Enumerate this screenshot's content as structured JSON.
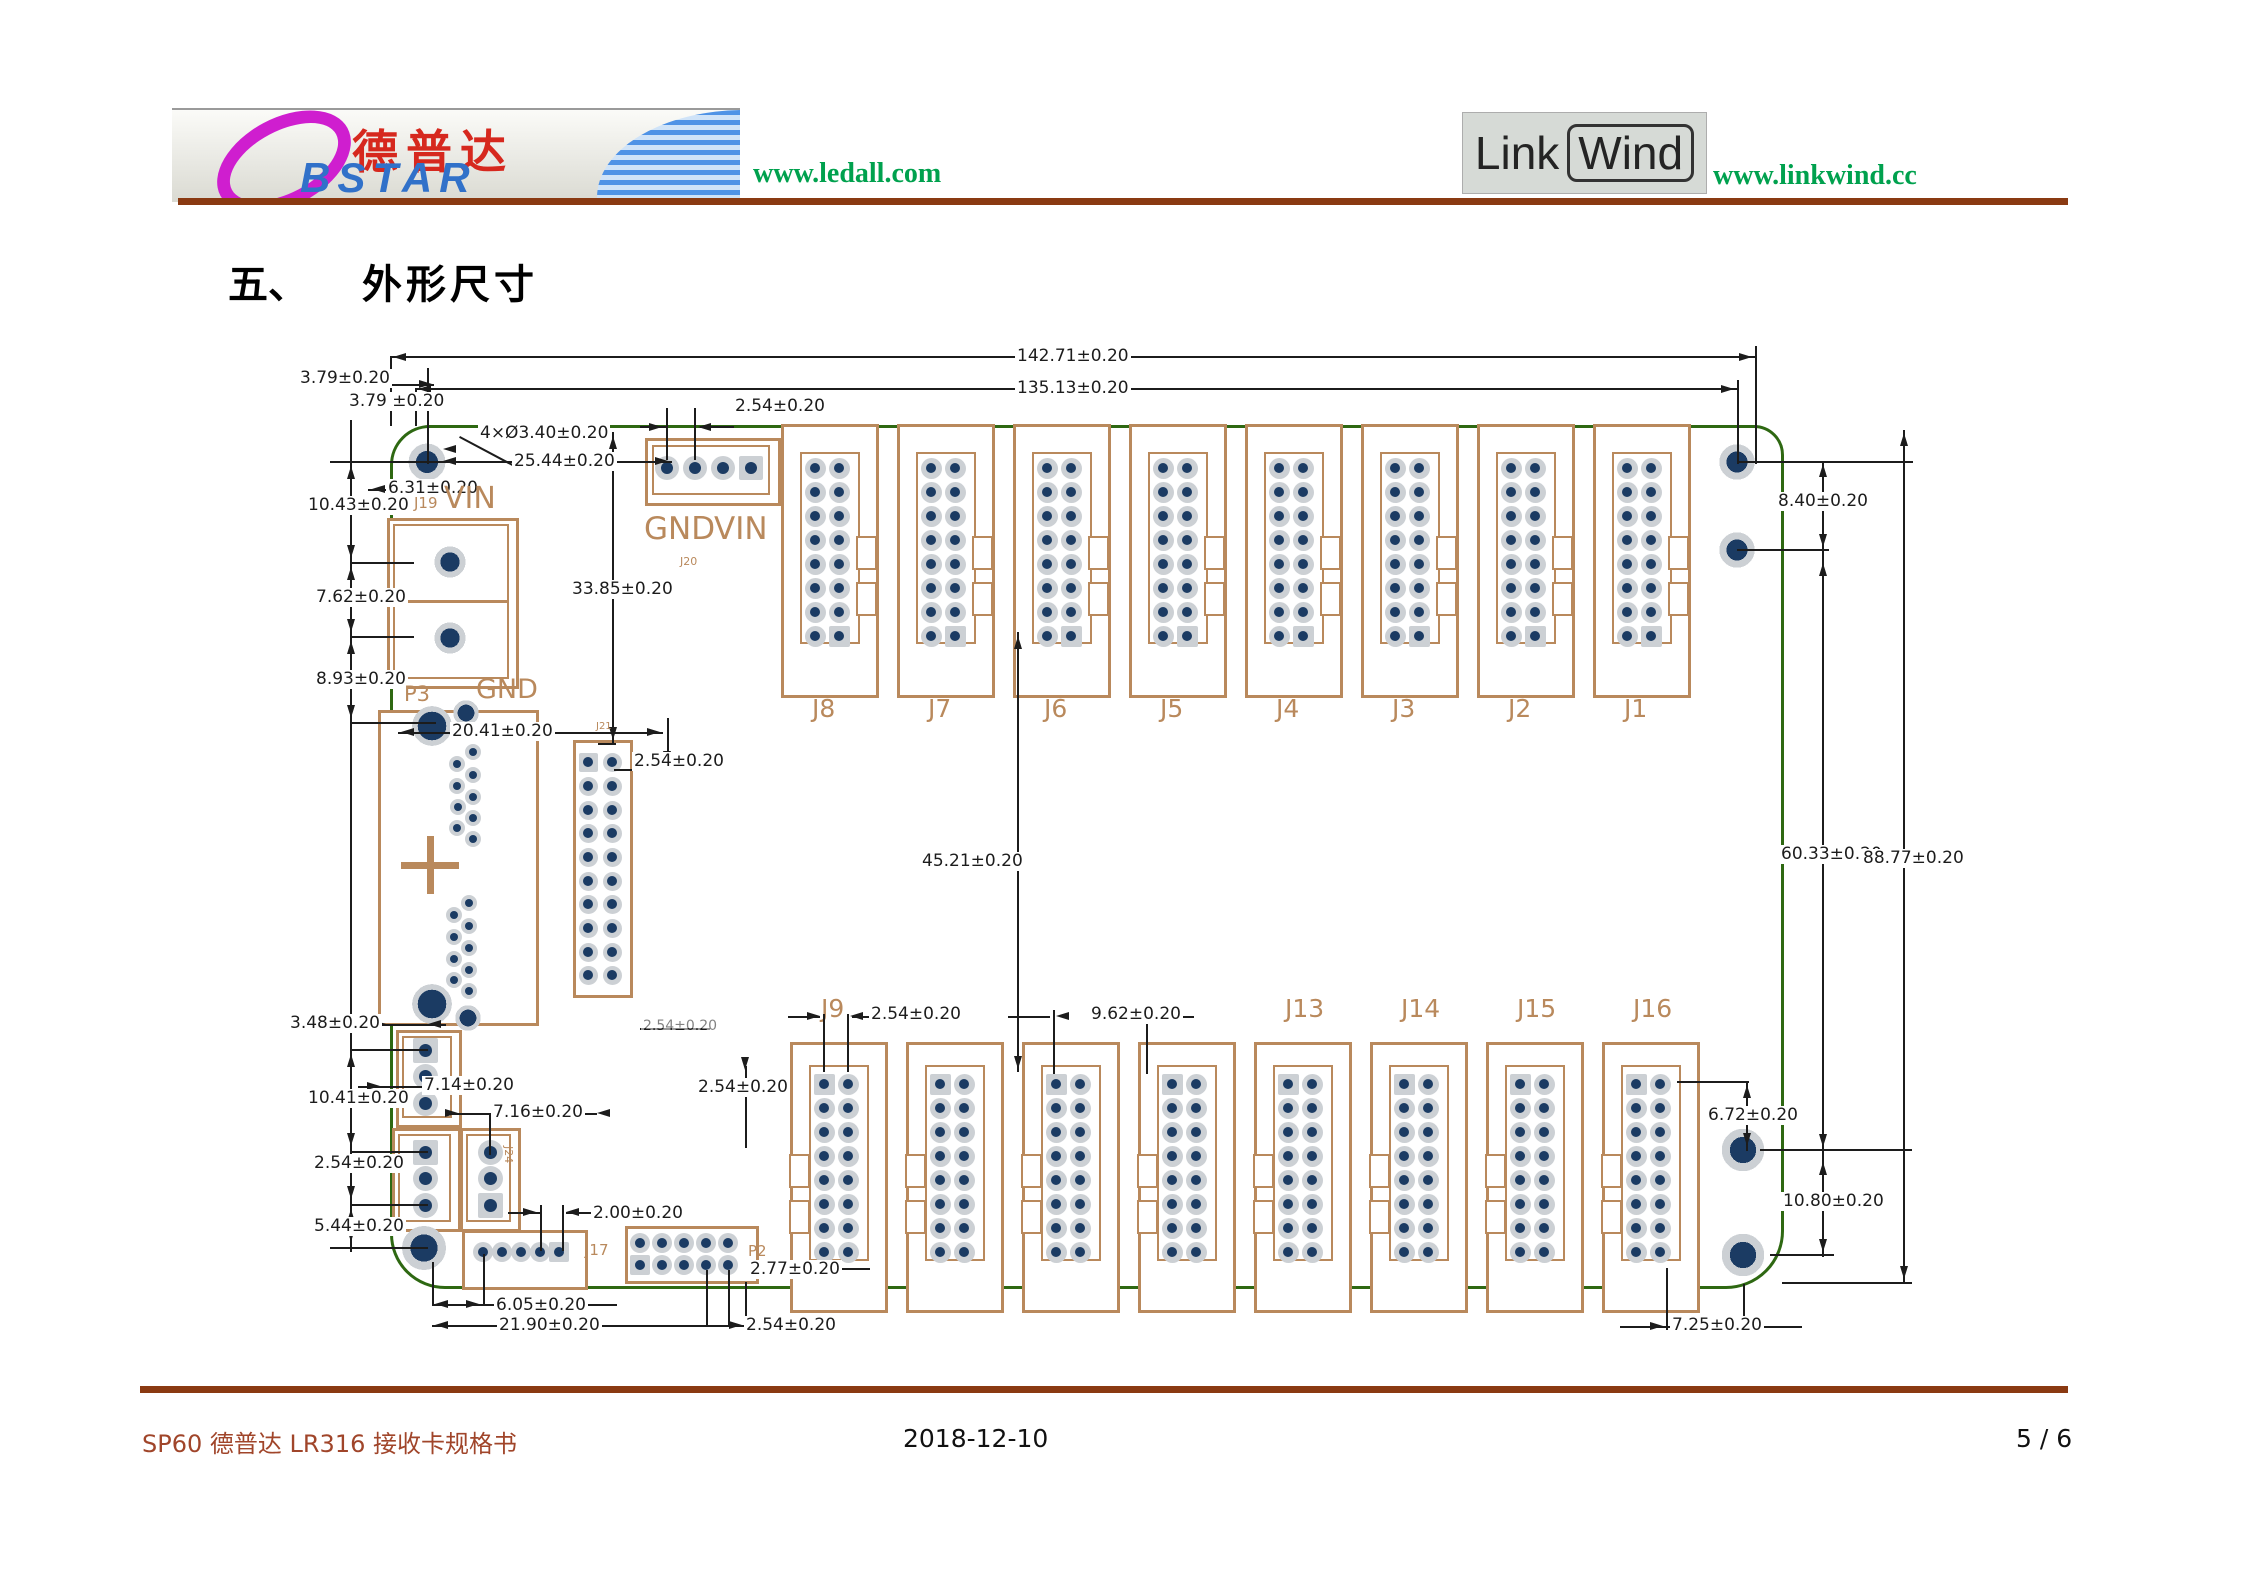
{
  "header": {
    "bstar_logo": {
      "d_initial": "D",
      "cn_name": "德普达",
      "en_name": "BSTAR"
    },
    "ledall_url": "www.ledall.com",
    "linkwind_logo": {
      "part1": "Link",
      "part2": "Wind"
    },
    "linkwind_url": "www.linkwind.cc"
  },
  "title": {
    "number": "五、",
    "text": "外形尺寸"
  },
  "footer": {
    "left": "SP60 德普达 LR316 接收卡规格书",
    "center": "2018-12-10",
    "right": "5 / 6"
  },
  "drawing": {
    "colors": {
      "board": "#2e6812",
      "tan": "#b9895c",
      "navy": "#1b3b63",
      "halo": "#ccd0d4",
      "dim": "#1c1c1c"
    },
    "board": {
      "x": 390,
      "y": 425,
      "w": 1388,
      "h": 858
    },
    "top_row": {
      "labels": [
        "J8",
        "J7",
        "J6",
        "J5",
        "J4",
        "J3",
        "J2",
        "J1"
      ],
      "lefts": [
        781,
        897,
        1013,
        1129,
        1245,
        1361,
        1477,
        1593
      ],
      "y": 424,
      "w": 92,
      "h": 268,
      "inner": [
        19,
        28,
        56,
        188
      ],
      "cols": [
        34,
        58
      ],
      "rows": [
        44,
        68,
        92,
        116,
        140,
        164,
        188,
        212
      ],
      "pin": 21,
      "sq": [
        15
      ],
      "notch": "r",
      "label_y": 696
    },
    "bottom_row": {
      "labels": [
        "J9",
        "",
        "",
        "",
        "J13",
        "J14",
        "J15",
        "J16"
      ],
      "lefts": [
        790,
        906,
        1022,
        1138,
        1254,
        1370,
        1486,
        1602
      ],
      "y": 1042,
      "w": 92,
      "h": 265,
      "inner": [
        19,
        23,
        56,
        192
      ],
      "cols": [
        34,
        58
      ],
      "rows": [
        42,
        66,
        90,
        114,
        138,
        162,
        186,
        210
      ],
      "pin": 21,
      "sq": [
        0
      ],
      "notch": "l",
      "label_y": 996
    },
    "blocks": [
      {
        "name": "J19",
        "x": 387,
        "y": 518,
        "w": 126,
        "h": 165,
        "inner": [
          6,
          6,
          112,
          151
        ],
        "divider": 82,
        "cols": [],
        "rows": [],
        "pin": 0,
        "sq": []
      },
      {
        "name": "J20",
        "x": 645,
        "y": 438,
        "w": 130,
        "h": 62,
        "inner": [
          7,
          7,
          114,
          46
        ],
        "cols": [
          22,
          50,
          78,
          106
        ],
        "rows": [
          30
        ],
        "pin": 24,
        "sq": [
          3
        ]
      },
      {
        "name": "P3",
        "x": 378,
        "y": 710,
        "w": 155,
        "h": 310,
        "cols": [],
        "rows": [],
        "pin": 0,
        "sq": []
      },
      {
        "name": "J21",
        "x": 573,
        "y": 740,
        "w": 54,
        "h": 252,
        "cols": [
          15,
          39
        ],
        "rows": [
          22,
          46,
          70,
          93,
          117,
          141,
          164,
          188,
          212,
          235
        ],
        "pin": 19,
        "sq": [
          0
        ]
      },
      {
        "name": "conn-3pin-a",
        "x": 396,
        "y": 1030,
        "w": 60,
        "h": 92,
        "inner": [
          6,
          6,
          46,
          78
        ],
        "cols": [
          29
        ],
        "rows": [
          20,
          46,
          73
        ],
        "pin": 25,
        "sq": [
          0
        ]
      },
      {
        "name": "conn-3pin-b",
        "x": 392,
        "y": 1128,
        "w": 63,
        "h": 98,
        "inner": [
          6,
          6,
          49,
          84
        ],
        "cols": [
          33
        ],
        "rows": [
          24,
          50,
          77
        ],
        "pin": 25,
        "sq": [
          0
        ]
      },
      {
        "name": "J24",
        "x": 460,
        "y": 1128,
        "w": 55,
        "h": 98,
        "inner": [
          6,
          6,
          41,
          84
        ],
        "cols": [
          30
        ],
        "rows": [
          24,
          50,
          77
        ],
        "pin": 25,
        "sq": [
          2
        ]
      },
      {
        "name": "J17",
        "x": 462,
        "y": 1230,
        "w": 120,
        "h": 54,
        "cols": [
          21,
          40,
          59,
          78,
          97
        ],
        "rows": [
          22
        ],
        "pin": 20,
        "sq": [
          4
        ]
      },
      {
        "name": "P2",
        "x": 625,
        "y": 1226,
        "w": 128,
        "h": 52,
        "cols": [
          15,
          37,
          59,
          81,
          103
        ],
        "rows": [
          17,
          39
        ],
        "pin": 20,
        "sq": [
          5
        ]
      }
    ],
    "rings": [
      [
        450,
        562,
        44,
        62
      ],
      [
        450,
        638,
        44,
        62
      ],
      [
        432,
        726,
        56,
        72
      ],
      [
        432,
        1004,
        56,
        72
      ],
      [
        466,
        713,
        36,
        66
      ],
      [
        468,
        1018,
        36,
        66
      ],
      [
        427,
        462,
        52,
        60
      ],
      [
        1737,
        462,
        50,
        60
      ],
      [
        1737,
        550,
        50,
        60
      ],
      [
        424,
        1248,
        62,
        62
      ],
      [
        1743,
        1150,
        60,
        62
      ],
      [
        1743,
        1255,
        60,
        62
      ]
    ],
    "small_pads": [
      [
        473,
        752
      ],
      [
        457,
        764
      ],
      [
        473,
        775
      ],
      [
        457,
        786
      ],
      [
        473,
        797
      ],
      [
        458,
        807
      ],
      [
        473,
        818
      ],
      [
        457,
        828
      ],
      [
        473,
        839
      ],
      [
        469,
        903
      ],
      [
        454,
        915
      ],
      [
        469,
        926
      ],
      [
        454,
        937
      ],
      [
        469,
        948
      ],
      [
        454,
        959
      ],
      [
        469,
        970
      ],
      [
        454,
        980
      ],
      [
        469,
        991
      ]
    ],
    "cross": {
      "x": 430,
      "y": 865,
      "arm": 29,
      "t": 7
    },
    "lines": [
      [
        390,
        356,
        1365,
        2
      ],
      [
        415,
        388,
        1322,
        2
      ],
      [
        390,
        356,
        2,
        70
      ],
      [
        415,
        388,
        2,
        38
      ],
      [
        1755,
        346,
        2,
        118
      ],
      [
        1737,
        380,
        2,
        84
      ],
      [
        350,
        420,
        2,
        832
      ],
      [
        330,
        461,
        118,
        2
      ],
      [
        350,
        562,
        64,
        2
      ],
      [
        350,
        636,
        64,
        2
      ],
      [
        350,
        722,
        86,
        2
      ],
      [
        368,
        384,
        66,
        2
      ],
      [
        352,
        406,
        82,
        2
      ],
      [
        427,
        368,
        2,
        96
      ],
      [
        460,
        436,
        60,
        2,
        28
      ],
      [
        440,
        461,
        232,
        2
      ],
      [
        612,
        432,
        2,
        312
      ],
      [
        598,
        743,
        18,
        2
      ],
      [
        666,
        408,
        2,
        52
      ],
      [
        694,
        408,
        2,
        52
      ],
      [
        640,
        426,
        26,
        2
      ],
      [
        700,
        426,
        34,
        2
      ],
      [
        368,
        489,
        96,
        2
      ],
      [
        1017,
        632,
        2,
        440
      ],
      [
        1822,
        461,
        2,
        796
      ],
      [
        1903,
        430,
        2,
        854
      ],
      [
        1737,
        461,
        176,
        2
      ],
      [
        1737,
        549,
        92,
        2
      ],
      [
        1760,
        1149,
        152,
        2
      ],
      [
        1770,
        1254,
        64,
        2
      ],
      [
        1782,
        1282,
        130,
        2
      ],
      [
        1677,
        1081,
        72,
        2
      ],
      [
        1746,
        1081,
        2,
        70
      ],
      [
        1666,
        1268,
        2,
        62
      ],
      [
        1743,
        1284,
        2,
        46
      ],
      [
        1620,
        1326,
        50,
        2
      ],
      [
        1748,
        1326,
        54,
        2
      ],
      [
        352,
        1024,
        94,
        2
      ],
      [
        350,
        1049,
        78,
        2
      ],
      [
        350,
        1151,
        78,
        2
      ],
      [
        350,
        1204,
        78,
        2
      ],
      [
        330,
        1247,
        98,
        2
      ],
      [
        358,
        1086,
        142,
        2
      ],
      [
        445,
        1113,
        152,
        2
      ],
      [
        489,
        1115,
        2,
        40
      ],
      [
        540,
        1205,
        2,
        46
      ],
      [
        562,
        1205,
        2,
        46
      ],
      [
        508,
        1212,
        32,
        2
      ],
      [
        566,
        1212,
        30,
        2
      ],
      [
        745,
        1066,
        2,
        82
      ],
      [
        700,
        1087,
        44,
        2
      ],
      [
        822,
        1268,
        48,
        2
      ],
      [
        432,
        1262,
        2,
        44
      ],
      [
        483,
        1254,
        2,
        52
      ],
      [
        432,
        1304,
        185,
        2
      ],
      [
        432,
        1325,
        315,
        2
      ],
      [
        745,
        1282,
        2,
        45
      ],
      [
        706,
        1270,
        2,
        56
      ],
      [
        728,
        1270,
        2,
        56
      ],
      [
        398,
        732,
        265,
        2
      ],
      [
        823,
        1014,
        2,
        58
      ],
      [
        847,
        1014,
        2,
        58
      ],
      [
        788,
        1016,
        32,
        2
      ],
      [
        852,
        1016,
        18,
        2
      ],
      [
        1053,
        1010,
        2,
        64
      ],
      [
        1146,
        1010,
        2,
        64
      ],
      [
        1008,
        1016,
        42,
        2
      ],
      [
        1152,
        1016,
        42,
        2
      ],
      [
        640,
        1028,
        70,
        2
      ],
      [
        667,
        718,
        2,
        48
      ],
      [
        614,
        769,
        90,
        2
      ]
    ],
    "arrows": [
      [
        393,
        357,
        "l"
      ],
      [
        1752,
        357,
        "r"
      ],
      [
        418,
        389,
        "l"
      ],
      [
        1734,
        389,
        "r"
      ],
      [
        371,
        384,
        "l"
      ],
      [
        432,
        384,
        "r"
      ],
      [
        355,
        406,
        "l"
      ],
      [
        432,
        406,
        "r"
      ],
      [
        443,
        461,
        "l"
      ],
      [
        668,
        461,
        "r"
      ],
      [
        372,
        489,
        "l"
      ],
      [
        462,
        489,
        "r"
      ],
      [
        662,
        427,
        "r"
      ],
      [
        698,
        427,
        "l"
      ],
      [
        613,
        436,
        "u"
      ],
      [
        613,
        740,
        "d"
      ],
      [
        667,
        764,
        "d"
      ],
      [
        401,
        732,
        "l"
      ],
      [
        660,
        732,
        "r"
      ],
      [
        1018,
        636,
        "u"
      ],
      [
        1018,
        1069,
        "d"
      ],
      [
        1904,
        433,
        "u"
      ],
      [
        1904,
        1279,
        "d"
      ],
      [
        1823,
        464,
        "u"
      ],
      [
        1823,
        547,
        "d"
      ],
      [
        1823,
        563,
        "u"
      ],
      [
        1823,
        1147,
        "d"
      ],
      [
        1823,
        1162,
        "u"
      ],
      [
        1823,
        1252,
        "d"
      ],
      [
        351,
        466,
        "u"
      ],
      [
        351,
        558,
        "d"
      ],
      [
        351,
        567,
        "u"
      ],
      [
        351,
        632,
        "d"
      ],
      [
        351,
        641,
        "u"
      ],
      [
        351,
        718,
        "d"
      ],
      [
        351,
        1054,
        "u"
      ],
      [
        351,
        1146,
        "d"
      ],
      [
        351,
        1156,
        "u"
      ],
      [
        351,
        1199,
        "d"
      ],
      [
        351,
        1209,
        "u"
      ],
      [
        351,
        1242,
        "d"
      ],
      [
        1747,
        1085,
        "u"
      ],
      [
        1747,
        1146,
        "d"
      ],
      [
        1663,
        1326,
        "r"
      ],
      [
        1751,
        1326,
        "l"
      ],
      [
        435,
        1304,
        "l"
      ],
      [
        479,
        1304,
        "r"
      ],
      [
        435,
        1325,
        "l"
      ],
      [
        742,
        1325,
        "r"
      ],
      [
        820,
        1016,
        "r"
      ],
      [
        850,
        1016,
        "l"
      ],
      [
        1056,
        1016,
        "l"
      ],
      [
        1143,
        1016,
        "r"
      ],
      [
        380,
        1086,
        "r"
      ],
      [
        497,
        1086,
        "l"
      ],
      [
        458,
        1113,
        "r"
      ],
      [
        597,
        1113,
        "l"
      ],
      [
        536,
        1212,
        "r"
      ],
      [
        566,
        1212,
        "l"
      ],
      [
        745,
        1070,
        "d"
      ],
      [
        824,
        1268,
        "l"
      ],
      [
        443,
        449,
        "l"
      ],
      [
        386,
        1024,
        "r"
      ],
      [
        428,
        1024,
        "l"
      ]
    ],
    "dim_labels": [
      {
        "t": "142.71±0.20",
        "x": 1015,
        "y": 347
      },
      {
        "t": "135.13±0.20",
        "x": 1015,
        "y": 379
      },
      {
        "t": "3.79±0.20",
        "x": 298,
        "y": 369
      },
      {
        "t": "3.79 ±0.20",
        "x": 347,
        "y": 392
      },
      {
        "t": "4×Ø3.40±0.20",
        "x": 478,
        "y": 424
      },
      {
        "t": "25.44±0.20",
        "x": 512,
        "y": 452
      },
      {
        "t": "2.54±0.20",
        "x": 733,
        "y": 397
      },
      {
        "t": "6.31±0.20",
        "x": 386,
        "y": 479
      },
      {
        "t": "10.43±0.20",
        "x": 306,
        "y": 496
      },
      {
        "t": "7.62±0.20",
        "x": 314,
        "y": 588
      },
      {
        "t": "8.93±0.20",
        "x": 314,
        "y": 670
      },
      {
        "t": "33.85±0.20",
        "x": 570,
        "y": 580
      },
      {
        "t": "20.41±0.20",
        "x": 450,
        "y": 722
      },
      {
        "t": "2.54±0.20",
        "x": 632,
        "y": 752
      },
      {
        "t": "8.40±0.20",
        "x": 1776,
        "y": 492
      },
      {
        "t": "45.21±0.20",
        "x": 920,
        "y": 852
      },
      {
        "t": "60.33±0.20",
        "x": 1779,
        "y": 845
      },
      {
        "t": "88.77±0.20",
        "x": 1861,
        "y": 849
      },
      {
        "t": "2.54±0.20",
        "x": 869,
        "y": 1005
      },
      {
        "t": "9.62±0.20",
        "x": 1089,
        "y": 1005
      },
      {
        "t": "3.48±0.20",
        "x": 288,
        "y": 1014
      },
      {
        "t": "10.41±0.20",
        "x": 306,
        "y": 1089
      },
      {
        "t": "2.54±0.20",
        "x": 312,
        "y": 1154
      },
      {
        "t": "5.44±0.20",
        "x": 312,
        "y": 1217
      },
      {
        "t": "7.14±0.20",
        "x": 422,
        "y": 1076
      },
      {
        "t": "7.16±0.20",
        "x": 491,
        "y": 1103
      },
      {
        "t": "2.00±0.20",
        "x": 591,
        "y": 1204
      },
      {
        "t": "2.54±0.20",
        "x": 696,
        "y": 1078
      },
      {
        "t": "2.77±0.20",
        "x": 748,
        "y": 1260
      },
      {
        "t": "6.05±0.20",
        "x": 494,
        "y": 1296
      },
      {
        "t": "21.90±0.20",
        "x": 497,
        "y": 1316
      },
      {
        "t": "2.54±0.20",
        "x": 744,
        "y": 1316
      },
      {
        "t": "6.72±0.20",
        "x": 1706,
        "y": 1106
      },
      {
        "t": "10.80±0.20",
        "x": 1781,
        "y": 1192
      },
      {
        "t": "7.25±0.20",
        "x": 1670,
        "y": 1316
      },
      {
        "t": "2.54±0.20",
        "x": 641,
        "y": 1019,
        "s": 14,
        "o": 0.55
      }
    ],
    "silk_labels": [
      {
        "t": "J19",
        "x": 414,
        "y": 496,
        "s": 15
      },
      {
        "t": "VIN",
        "x": 444,
        "y": 484,
        "s": 30
      },
      {
        "t": "GND",
        "x": 644,
        "y": 514,
        "s": 31
      },
      {
        "t": "VIN",
        "x": 714,
        "y": 514,
        "s": 31
      },
      {
        "t": "J20",
        "x": 680,
        "y": 556,
        "s": 11
      },
      {
        "t": "P3",
        "x": 404,
        "y": 684,
        "s": 21
      },
      {
        "t": "GND",
        "x": 476,
        "y": 676,
        "s": 27
      },
      {
        "t": "J21",
        "x": 596,
        "y": 722,
        "s": 10
      },
      {
        "t": "J24",
        "x": 514,
        "y": 1146,
        "s": 11,
        "r": 90
      },
      {
        "t": "J17",
        "x": 585,
        "y": 1243,
        "s": 15
      },
      {
        "t": "P2",
        "x": 748,
        "y": 1244,
        "s": 15
      }
    ]
  }
}
